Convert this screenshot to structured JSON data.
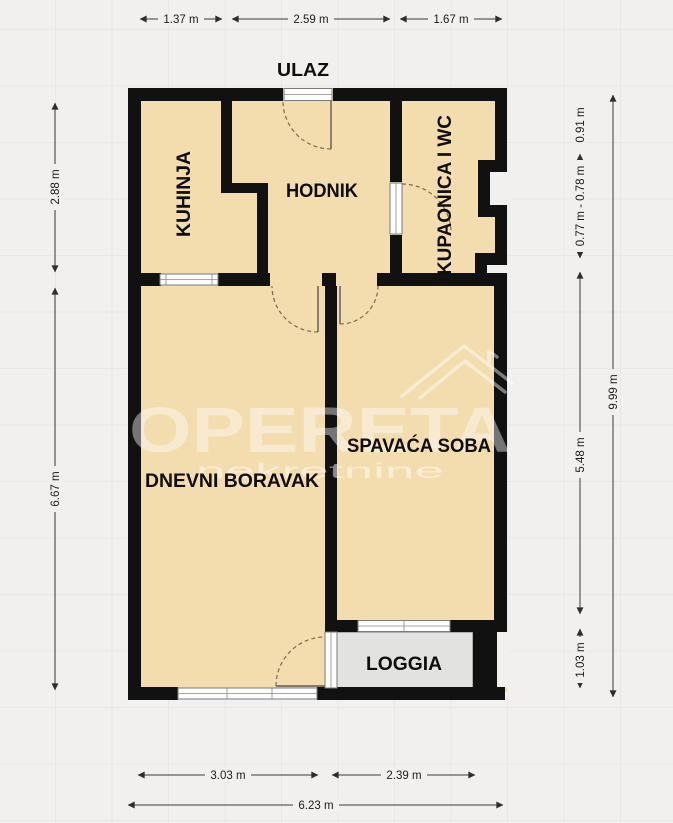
{
  "title": "apartment-floor-plan",
  "entrance": {
    "label": "ULAZ"
  },
  "rooms": {
    "kuhinja": {
      "label": "KUHINJA"
    },
    "hodnik": {
      "label": "HODNIK"
    },
    "kupaonica": {
      "label": "KUPAONICA I WC"
    },
    "dnevni": {
      "label": "DNEVNI BORAVAK"
    },
    "spavaca": {
      "label": "SPAVAĆA SOBA"
    },
    "loggia": {
      "label": "LOGGIA"
    }
  },
  "dimensions": {
    "top": [
      "1.37 m",
      "2.59 m",
      "1.67 m"
    ],
    "left": [
      "2.88 m",
      "6.67 m"
    ],
    "right": [
      "0.91 m",
      "0.77 m - 0.78 m",
      "5.48 m",
      "1.03 m",
      "9.99 m"
    ],
    "bottom": [
      "3.03 m",
      "2.39 m",
      "6.23 m"
    ]
  },
  "watermark": {
    "brand": "OPERETA",
    "sub": "nekretnine"
  },
  "colors": {
    "wall": "#111111",
    "floor": "#f3dcae",
    "loggia_floor": "#e2e2e1",
    "background": "#f1f0ee",
    "dimension": "#3a3a3a"
  }
}
